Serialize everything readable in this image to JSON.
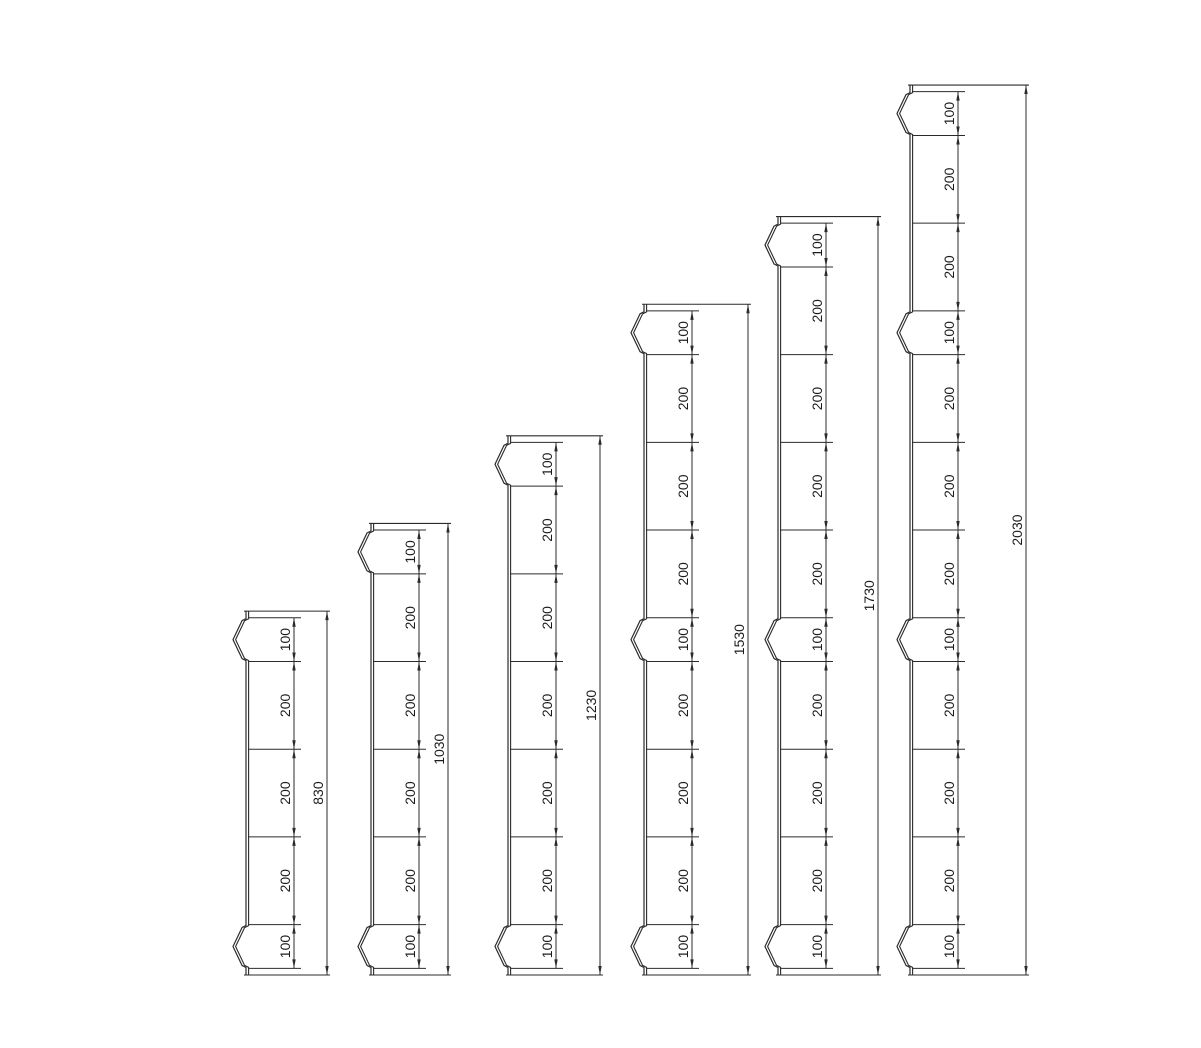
{
  "background_color": "#ffffff",
  "line_color": "#2b2b2b",
  "text_color": "#1c1c1c",
  "layout": {
    "canvas_width": 1201,
    "canvas_height": 1048,
    "baseline_y": 975,
    "scale_px_per_mm": 0.4384,
    "chain_offset": 48,
    "notch_depth": 13,
    "font_size": 14
  },
  "posts": [
    {
      "id": "post-830",
      "total": 830,
      "total_label": "830",
      "segments": [
        100,
        200,
        200,
        200,
        100
      ],
      "segment_labels": [
        "100",
        "200",
        "200",
        "200",
        "100"
      ],
      "notch_segments": [
        0,
        4
      ],
      "x_left": 246,
      "x_dim": 327
    },
    {
      "id": "post-1030",
      "total": 1030,
      "total_label": "1030",
      "segments": [
        100,
        200,
        200,
        200,
        200,
        100
      ],
      "segment_labels": [
        "100",
        "200",
        "200",
        "200",
        "200",
        "100"
      ],
      "notch_segments": [
        0,
        5
      ],
      "x_left": 371,
      "x_dim": 448
    },
    {
      "id": "post-1230",
      "total": 1230,
      "total_label": "1230",
      "segments": [
        100,
        200,
        200,
        200,
        200,
        200,
        100
      ],
      "segment_labels": [
        "100",
        "200",
        "200",
        "200",
        "200",
        "200",
        "100"
      ],
      "notch_segments": [
        0,
        6
      ],
      "x_left": 508,
      "x_dim": 600
    },
    {
      "id": "post-1530",
      "total": 1530,
      "total_label": "1530",
      "segments": [
        100,
        200,
        200,
        200,
        100,
        200,
        200,
        200,
        100
      ],
      "segment_labels": [
        "100",
        "200",
        "200",
        "200",
        "100",
        "200",
        "200",
        "200",
        "100"
      ],
      "notch_segments": [
        0,
        4,
        8
      ],
      "x_left": 644,
      "x_dim": 748
    },
    {
      "id": "post-1730",
      "total": 1730,
      "total_label": "1730",
      "segments": [
        100,
        200,
        200,
        200,
        200,
        100,
        200,
        200,
        200,
        100
      ],
      "segment_labels": [
        "100",
        "200",
        "200",
        "200",
        "200",
        "100",
        "200",
        "200",
        "200",
        "100"
      ],
      "notch_segments": [
        0,
        5,
        9
      ],
      "x_left": 778,
      "x_dim": 878
    },
    {
      "id": "post-2030",
      "total": 2030,
      "total_label": "2030",
      "segments": [
        100,
        200,
        200,
        100,
        200,
        200,
        200,
        100,
        200,
        200,
        200,
        100
      ],
      "segment_labels": [
        "100",
        "200",
        "200",
        "100",
        "200",
        "200",
        "200",
        "100",
        "200",
        "200",
        "200",
        "100"
      ],
      "notch_segments": [
        0,
        3,
        7,
        11
      ],
      "x_left": 910,
      "x_dim": 1026
    }
  ]
}
